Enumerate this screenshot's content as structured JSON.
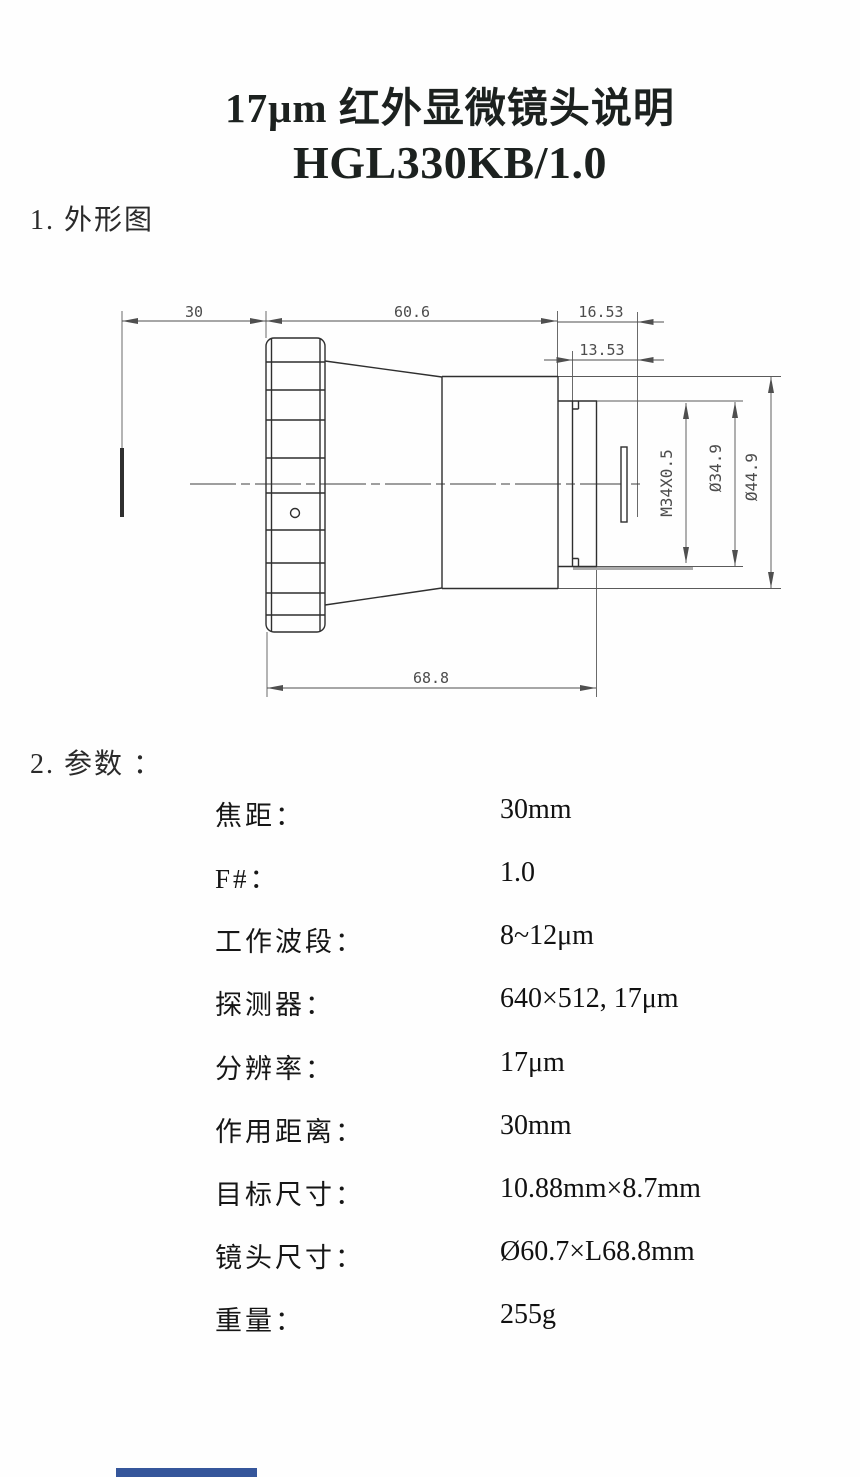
{
  "title": {
    "line1": "17μm 红外显微镜头说明",
    "line2": "HGL330KB/1.0"
  },
  "sections": {
    "outline_heading": "1. 外形图",
    "params_heading": "2. 参数 ："
  },
  "drawing": {
    "dims": {
      "working_distance": "30",
      "body_length": "60.6",
      "rear_length": "16.53",
      "flange_length": "13.53",
      "total_length": "68.8",
      "thread": "M34X0.5",
      "mount_diameter": "Ø34.9",
      "body_diameter": "Ø44.9"
    }
  },
  "params": {
    "rows": [
      {
        "label": "焦距：",
        "value": "30mm"
      },
      {
        "label": "F#：",
        "value": "1.0"
      },
      {
        "label": "工作波段：",
        "value": "8~12μm"
      },
      {
        "label": "探测器：",
        "value": "640×512, 17μm"
      },
      {
        "label": "分辨率：",
        "value": "17μm"
      },
      {
        "label": "作用距离：",
        "value": "30mm"
      },
      {
        "label": "目标尺寸：",
        "value": "10.88mm×8.7mm"
      },
      {
        "label": "镜头尺寸：",
        "value": "Ø60.7×L68.8mm"
      },
      {
        "label": "重量：",
        "value": "255g"
      }
    ]
  },
  "footer": {
    "accent_color": "#35569b"
  }
}
